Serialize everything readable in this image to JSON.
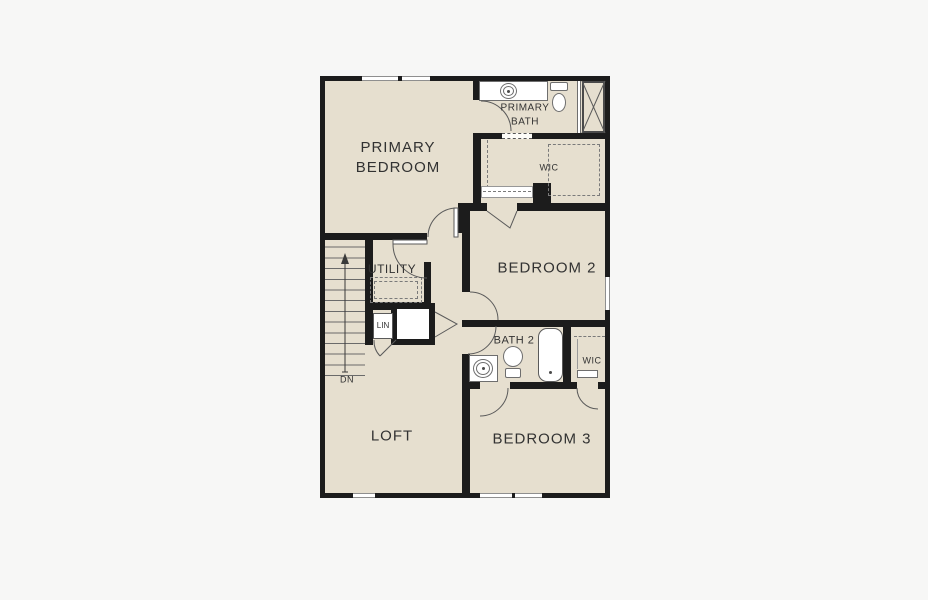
{
  "plan_type": "floor-plan",
  "palette": {
    "page_background": "#f7f7f6",
    "floor": "#e6dfcf",
    "wall": "#1c1c1c",
    "fixture_line": "#5a5a5a",
    "text": "#323232"
  },
  "rooms": {
    "primary_bedroom": {
      "label_line1": "PRIMARY",
      "label_line2": "BEDROOM"
    },
    "primary_bath": {
      "label_line1": "PRIMARY",
      "label_line2": "BATH"
    },
    "wic_upper": {
      "label": "WIC"
    },
    "bedroom2": {
      "label": "BEDROOM 2"
    },
    "utility": {
      "label": "UTILITY"
    },
    "linen": {
      "label": "LIN"
    },
    "bath2": {
      "label": "BATH 2"
    },
    "wic_lower": {
      "label": "WIC"
    },
    "loft": {
      "label": "LOFT"
    },
    "bedroom3": {
      "label": "BEDROOM 3"
    }
  },
  "stairs": {
    "direction_label": "DN"
  }
}
